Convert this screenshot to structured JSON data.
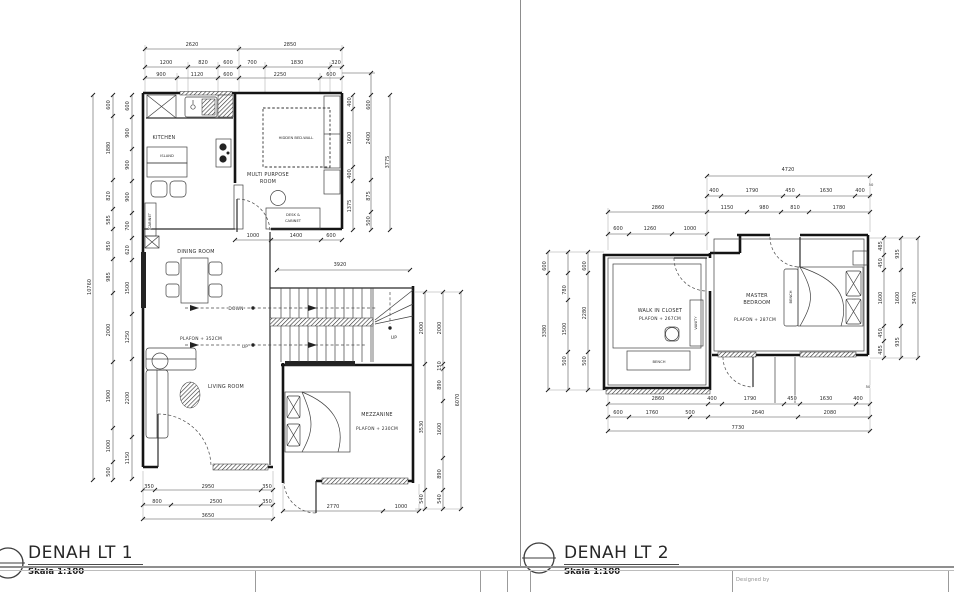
{
  "page": {
    "bg": "#ffffff",
    "line_color": "#4a4a4a",
    "wall_color": "#141414"
  },
  "footer": {
    "designed_by": "Designed by"
  },
  "plans": [
    {
      "id": "lt1",
      "title": "DENAH LT 1",
      "scale": "Skala 1:100",
      "texts": [
        {
          "t": "2620",
          "x": 192,
          "y": 46,
          "k": "d"
        },
        {
          "t": "2850",
          "x": 290,
          "y": 46,
          "k": "d"
        },
        {
          "t": "1200",
          "x": 166,
          "y": 64,
          "k": "d"
        },
        {
          "t": "820",
          "x": 203,
          "y": 64,
          "k": "d"
        },
        {
          "t": "600",
          "x": 228,
          "y": 64,
          "k": "d"
        },
        {
          "t": "700",
          "x": 252,
          "y": 64,
          "k": "d"
        },
        {
          "t": "1830",
          "x": 297,
          "y": 64,
          "k": "d"
        },
        {
          "t": "320",
          "x": 336,
          "y": 64,
          "k": "d"
        },
        {
          "t": "900",
          "x": 161,
          "y": 76,
          "k": "d"
        },
        {
          "t": "1120",
          "x": 197,
          "y": 76,
          "k": "d"
        },
        {
          "t": "600",
          "x": 228,
          "y": 76,
          "k": "d"
        },
        {
          "t": "2250",
          "x": 280,
          "y": 76,
          "k": "d"
        },
        {
          "t": "600",
          "x": 331,
          "y": 76,
          "k": "d"
        },
        {
          "t": "10760",
          "x": 91,
          "y": 287,
          "k": "r"
        },
        {
          "t": "600",
          "x": 110,
          "y": 105,
          "k": "r"
        },
        {
          "t": "1880",
          "x": 110,
          "y": 148,
          "k": "r"
        },
        {
          "t": "820",
          "x": 110,
          "y": 196,
          "k": "r"
        },
        {
          "t": "585",
          "x": 110,
          "y": 220,
          "k": "r"
        },
        {
          "t": "850",
          "x": 110,
          "y": 246,
          "k": "r"
        },
        {
          "t": "985",
          "x": 110,
          "y": 277,
          "k": "r"
        },
        {
          "t": "2000",
          "x": 110,
          "y": 330,
          "k": "r"
        },
        {
          "t": "1900",
          "x": 110,
          "y": 396,
          "k": "r"
        },
        {
          "t": "1000",
          "x": 110,
          "y": 446,
          "k": "r"
        },
        {
          "t": "500",
          "x": 110,
          "y": 472,
          "k": "r"
        },
        {
          "t": "600",
          "x": 129,
          "y": 106,
          "k": "r"
        },
        {
          "t": "900",
          "x": 129,
          "y": 133,
          "k": "r"
        },
        {
          "t": "900",
          "x": 129,
          "y": 165,
          "k": "r"
        },
        {
          "t": "900",
          "x": 129,
          "y": 197,
          "k": "r"
        },
        {
          "t": "700",
          "x": 129,
          "y": 226,
          "k": "r"
        },
        {
          "t": "620",
          "x": 129,
          "y": 250,
          "k": "r"
        },
        {
          "t": "1500",
          "x": 129,
          "y": 288,
          "k": "r"
        },
        {
          "t": "1250",
          "x": 129,
          "y": 337,
          "k": "r"
        },
        {
          "t": "2200",
          "x": 129,
          "y": 398,
          "k": "r"
        },
        {
          "t": "1150",
          "x": 129,
          "y": 458,
          "k": "r"
        },
        {
          "t": "400",
          "x": 351,
          "y": 102,
          "k": "r"
        },
        {
          "t": "1600",
          "x": 351,
          "y": 138,
          "k": "r"
        },
        {
          "t": "400",
          "x": 351,
          "y": 174,
          "k": "r"
        },
        {
          "t": "1375",
          "x": 351,
          "y": 206,
          "k": "r"
        },
        {
          "t": "600",
          "x": 370,
          "y": 105,
          "k": "r"
        },
        {
          "t": "2400",
          "x": 370,
          "y": 138,
          "k": "r"
        },
        {
          "t": "875",
          "x": 370,
          "y": 196,
          "k": "r"
        },
        {
          "t": "500",
          "x": 370,
          "y": 221,
          "k": "r"
        },
        {
          "t": "3775",
          "x": 389,
          "y": 162,
          "k": "r"
        },
        {
          "t": "1000",
          "x": 253,
          "y": 237,
          "k": "d"
        },
        {
          "t": "1400",
          "x": 296,
          "y": 237,
          "k": "d"
        },
        {
          "t": "600",
          "x": 331,
          "y": 237,
          "k": "d"
        },
        {
          "t": "3920",
          "x": 340,
          "y": 266,
          "k": "d"
        },
        {
          "t": "2000",
          "x": 423,
          "y": 328,
          "k": "r"
        },
        {
          "t": "3530",
          "x": 423,
          "y": 427,
          "k": "r"
        },
        {
          "t": "540",
          "x": 423,
          "y": 499,
          "k": "r"
        },
        {
          "t": "2000",
          "x": 441,
          "y": 328,
          "k": "r"
        },
        {
          "t": "150",
          "x": 441,
          "y": 366,
          "k": "r"
        },
        {
          "t": "890",
          "x": 441,
          "y": 385,
          "k": "r"
        },
        {
          "t": "1600",
          "x": 441,
          "y": 429,
          "k": "r"
        },
        {
          "t": "890",
          "x": 441,
          "y": 474,
          "k": "r"
        },
        {
          "t": "540",
          "x": 441,
          "y": 499,
          "k": "r"
        },
        {
          "t": "6070",
          "x": 459,
          "y": 400,
          "k": "r"
        },
        {
          "t": "350",
          "x": 149,
          "y": 488,
          "k": "d"
        },
        {
          "t": "2950",
          "x": 208,
          "y": 488,
          "k": "d"
        },
        {
          "t": "350",
          "x": 267,
          "y": 488,
          "k": "d"
        },
        {
          "t": "800",
          "x": 157,
          "y": 503,
          "k": "d"
        },
        {
          "t": "2500",
          "x": 216,
          "y": 503,
          "k": "d"
        },
        {
          "t": "350",
          "x": 267,
          "y": 503,
          "k": "d"
        },
        {
          "t": "3650",
          "x": 208,
          "y": 517,
          "k": "d"
        },
        {
          "t": "2770",
          "x": 333,
          "y": 508,
          "k": "d"
        },
        {
          "t": "1000",
          "x": 401,
          "y": 508,
          "k": "d"
        },
        {
          "t": "KITCHEN",
          "x": 164,
          "y": 139,
          "k": "m"
        },
        {
          "t": "ISLAND",
          "x": 167,
          "y": 157,
          "k": "t"
        },
        {
          "t": "MULTI PURPOSE",
          "x": 268,
          "y": 176,
          "k": "m"
        },
        {
          "t": "ROOM",
          "x": 268,
          "y": 183,
          "k": "m"
        },
        {
          "t": "HIDDEN BED-WALL",
          "x": 296,
          "y": 139,
          "k": "t"
        },
        {
          "t": "DESK &",
          "x": 293,
          "y": 216,
          "k": "t"
        },
        {
          "t": "CABINET",
          "x": 293,
          "y": 222,
          "k": "t"
        },
        {
          "t": "CABINET",
          "x": 151,
          "y": 221,
          "k": "tr"
        },
        {
          "t": "DINING ROOM",
          "x": 196,
          "y": 253,
          "k": "m"
        },
        {
          "t": "PLAFON + 352CM",
          "x": 201,
          "y": 340,
          "k": "n"
        },
        {
          "t": "LIVING ROOM",
          "x": 226,
          "y": 388,
          "k": "m"
        },
        {
          "t": "MEZZANINE",
          "x": 377,
          "y": 416,
          "k": "m"
        },
        {
          "t": "PLAFON + 230CM",
          "x": 377,
          "y": 430,
          "k": "n"
        },
        {
          "t": "DOWN",
          "x": 236,
          "y": 310,
          "k": "n"
        },
        {
          "t": "UP",
          "x": 245,
          "y": 348,
          "k": "n"
        },
        {
          "t": "UP",
          "x": 394,
          "y": 339,
          "k": "n"
        }
      ]
    },
    {
      "id": "lt2",
      "title": "DENAH LT 2",
      "scale": "Skala 1:100",
      "texts": [
        {
          "t": "4720",
          "x": 788,
          "y": 171,
          "k": "d"
        },
        {
          "t": "400",
          "x": 714,
          "y": 192,
          "k": "d"
        },
        {
          "t": "1790",
          "x": 752,
          "y": 192,
          "k": "d"
        },
        {
          "t": "450",
          "x": 790,
          "y": 192,
          "k": "d"
        },
        {
          "t": "1630",
          "x": 826,
          "y": 192,
          "k": "d"
        },
        {
          "t": "400",
          "x": 860,
          "y": 192,
          "k": "d"
        },
        {
          "t": "50",
          "x": 871,
          "y": 186,
          "k": "t"
        },
        {
          "t": "2860",
          "x": 658,
          "y": 209,
          "k": "d"
        },
        {
          "t": "1150",
          "x": 727,
          "y": 209,
          "k": "d"
        },
        {
          "t": "980",
          "x": 764,
          "y": 209,
          "k": "d"
        },
        {
          "t": "810",
          "x": 795,
          "y": 209,
          "k": "d"
        },
        {
          "t": "1780",
          "x": 839,
          "y": 209,
          "k": "d"
        },
        {
          "t": "600",
          "x": 618,
          "y": 230,
          "k": "d"
        },
        {
          "t": "1260",
          "x": 650,
          "y": 230,
          "k": "d"
        },
        {
          "t": "1000",
          "x": 690,
          "y": 230,
          "k": "d"
        },
        {
          "t": "600",
          "x": 546,
          "y": 266,
          "k": "r"
        },
        {
          "t": "3380",
          "x": 546,
          "y": 331,
          "k": "r"
        },
        {
          "t": "780",
          "x": 566,
          "y": 290,
          "k": "r"
        },
        {
          "t": "1500",
          "x": 566,
          "y": 329,
          "k": "r"
        },
        {
          "t": "500",
          "x": 566,
          "y": 361,
          "k": "r"
        },
        {
          "t": "600",
          "x": 586,
          "y": 266,
          "k": "r"
        },
        {
          "t": "2280",
          "x": 586,
          "y": 313,
          "k": "r"
        },
        {
          "t": "500",
          "x": 586,
          "y": 361,
          "k": "r"
        },
        {
          "t": "485",
          "x": 882,
          "y": 246,
          "k": "r"
        },
        {
          "t": "450",
          "x": 882,
          "y": 263,
          "k": "r"
        },
        {
          "t": "1600",
          "x": 882,
          "y": 298,
          "k": "r"
        },
        {
          "t": "450",
          "x": 882,
          "y": 333,
          "k": "r"
        },
        {
          "t": "485",
          "x": 882,
          "y": 350,
          "k": "r"
        },
        {
          "t": "935",
          "x": 899,
          "y": 254,
          "k": "r"
        },
        {
          "t": "1600",
          "x": 899,
          "y": 298,
          "k": "r"
        },
        {
          "t": "935",
          "x": 899,
          "y": 342,
          "k": "r"
        },
        {
          "t": "3470",
          "x": 916,
          "y": 298,
          "k": "r"
        },
        {
          "t": "2860",
          "x": 658,
          "y": 400,
          "k": "d"
        },
        {
          "t": "400",
          "x": 712,
          "y": 400,
          "k": "d"
        },
        {
          "t": "1790",
          "x": 750,
          "y": 400,
          "k": "d"
        },
        {
          "t": "450",
          "x": 792,
          "y": 400,
          "k": "d"
        },
        {
          "t": "1630",
          "x": 826,
          "y": 400,
          "k": "d"
        },
        {
          "t": "400",
          "x": 858,
          "y": 400,
          "k": "d"
        },
        {
          "t": "50",
          "x": 868,
          "y": 388,
          "k": "t"
        },
        {
          "t": "600",
          "x": 618,
          "y": 414,
          "k": "d"
        },
        {
          "t": "1760",
          "x": 652,
          "y": 414,
          "k": "d"
        },
        {
          "t": "500",
          "x": 690,
          "y": 414,
          "k": "d"
        },
        {
          "t": "2640",
          "x": 758,
          "y": 414,
          "k": "d"
        },
        {
          "t": "2080",
          "x": 830,
          "y": 414,
          "k": "d"
        },
        {
          "t": "7730",
          "x": 738,
          "y": 429,
          "k": "d"
        },
        {
          "t": "WALK IN CLOSET",
          "x": 660,
          "y": 312,
          "k": "m"
        },
        {
          "t": "PLAFON + 267CM",
          "x": 660,
          "y": 320,
          "k": "n"
        },
        {
          "t": "VANITY",
          "x": 697,
          "y": 323,
          "k": "tr"
        },
        {
          "t": "BENCH",
          "x": 659,
          "y": 363,
          "k": "t"
        },
        {
          "t": "MASTER",
          "x": 757,
          "y": 297,
          "k": "m"
        },
        {
          "t": "BEDROOM",
          "x": 757,
          "y": 304,
          "k": "m"
        },
        {
          "t": "PLAFON + 287CM",
          "x": 755,
          "y": 321,
          "k": "n"
        },
        {
          "t": "BENCH",
          "x": 792,
          "y": 297,
          "k": "tr"
        }
      ]
    }
  ]
}
